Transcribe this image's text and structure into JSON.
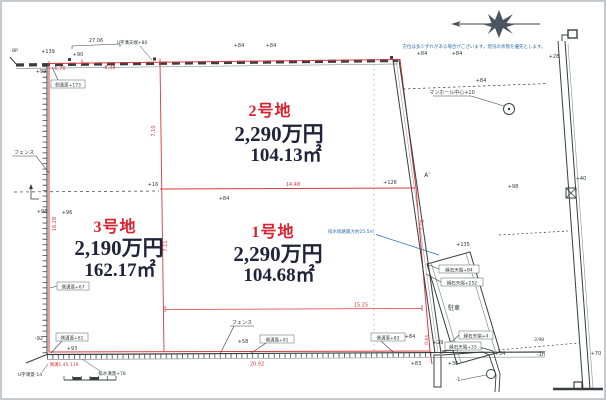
{
  "colors": {
    "red": "#d8393f",
    "blue": "#2f6fad",
    "ink": "#33363a",
    "price_ink": "#20243a"
  },
  "parcels": {
    "p2": {
      "name": "2号地",
      "price": "2,290万円",
      "area": "104.13㎡"
    },
    "p3": {
      "name": "3号地",
      "price": "2,190万円",
      "area": "162.17㎡"
    },
    "p1": {
      "name": "1号地",
      "price": "2,290万円",
      "area": "104.68㎡"
    }
  },
  "dims": {
    "top_bracket": "27.06",
    "top_a": "6.76",
    "top_b": "8.38",
    "mid": "14.48",
    "lower": "15.25",
    "bottom": "20.92",
    "left_side": "16.28",
    "div_upper": "7.10",
    "div_lower": "7.11",
    "right_side": "7.05",
    "ditch": "0.65",
    "gap": "3.98"
  },
  "box_labels": {
    "g173": "側溝蓋+173",
    "g67": "側溝蓋+67",
    "g61": "側溝蓋+61",
    "g91": "側溝蓋+91",
    "g83": "側溝蓋+83",
    "c84": "縁石天端+84",
    "c252": "縁石天端+252",
    "c4": "縁石天端+4",
    "c33": "縁石天端+33"
  },
  "labels": {
    "fence": "フェンス",
    "manhole": "マンホール中心+10",
    "parking": "駐車",
    "u_top": "U字溝天端+80",
    "u_btm": "U字溝蓋-14",
    "drain": "排水溝蓋+78",
    "gutter_note": "側溝1.45 119",
    "bp": "BP",
    "a_prime": "A'"
  },
  "notes": {
    "drain_blue": "排水経路最大約25.5m",
    "compass_disclaimer": "方位は多少ずれがある場合がございます。現況の状態を優先とします。"
  },
  "marks": {
    "e139": "+139",
    "e99": "+99",
    "e90": "+90",
    "e84": "+84",
    "e16": "+16",
    "e126": "+126",
    "e96": "+96",
    "e98": "+98",
    "e58": "+58",
    "e93": "+93",
    "en92": "-92",
    "e28": "+28",
    "e34": "+34",
    "en1n": "-1n",
    "e70": "+70",
    "e40": "+40",
    "e135": "+135",
    "e29": "+29",
    "e36": "+36",
    "e83": "+83",
    "en1": "-1"
  }
}
